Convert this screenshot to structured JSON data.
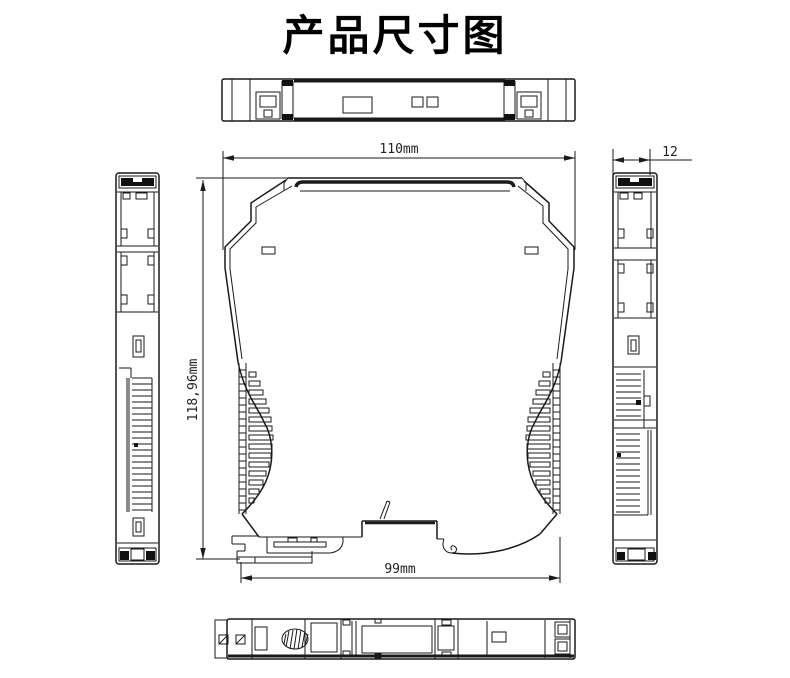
{
  "title": "产品尺寸图",
  "colors": {
    "line": "#1a1a1a",
    "background": "#ffffff"
  },
  "dimensions": {
    "front_width": "110mm",
    "front_height": "118,96mm",
    "base_width": "99mm",
    "side_width": "12"
  }
}
